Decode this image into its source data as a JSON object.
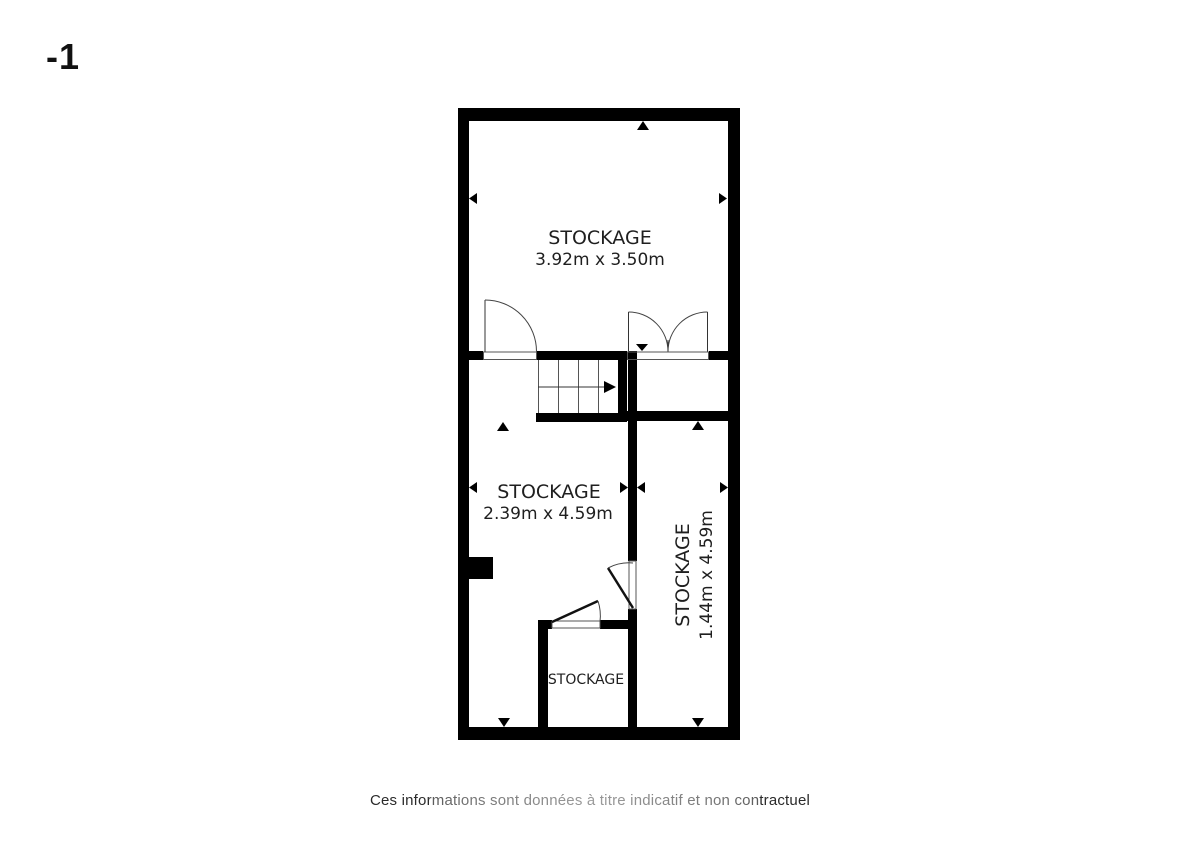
{
  "floor_label": "-1",
  "plan": {
    "rooms": [
      {
        "id": "storage-top",
        "name": "STOCKAGE",
        "dims": "3.92m x 3.50m"
      },
      {
        "id": "storage-middle",
        "name": "STOCKAGE",
        "dims": "2.39m x 4.59m"
      },
      {
        "id": "storage-right",
        "name": "STOCKAGE",
        "dims": "1.44m x 4.59m"
      },
      {
        "id": "storage-small",
        "name": "STOCKAGE"
      }
    ],
    "features": {
      "staircase": "staircase with direction arrow",
      "doors": [
        "single swing door top-left",
        "double swing door top-right",
        "swing door middle-right wall",
        "swing door small-storage"
      ],
      "dimension_markers": "small black triangle arrows on walls"
    }
  },
  "footer": {
    "disclaimer": "Ces informations sont données à titre indicatif et non contractuel"
  },
  "colors": {
    "wall": "#000000",
    "thin_line": "#555555",
    "text": "#1f1f1f",
    "background": "#ffffff"
  }
}
